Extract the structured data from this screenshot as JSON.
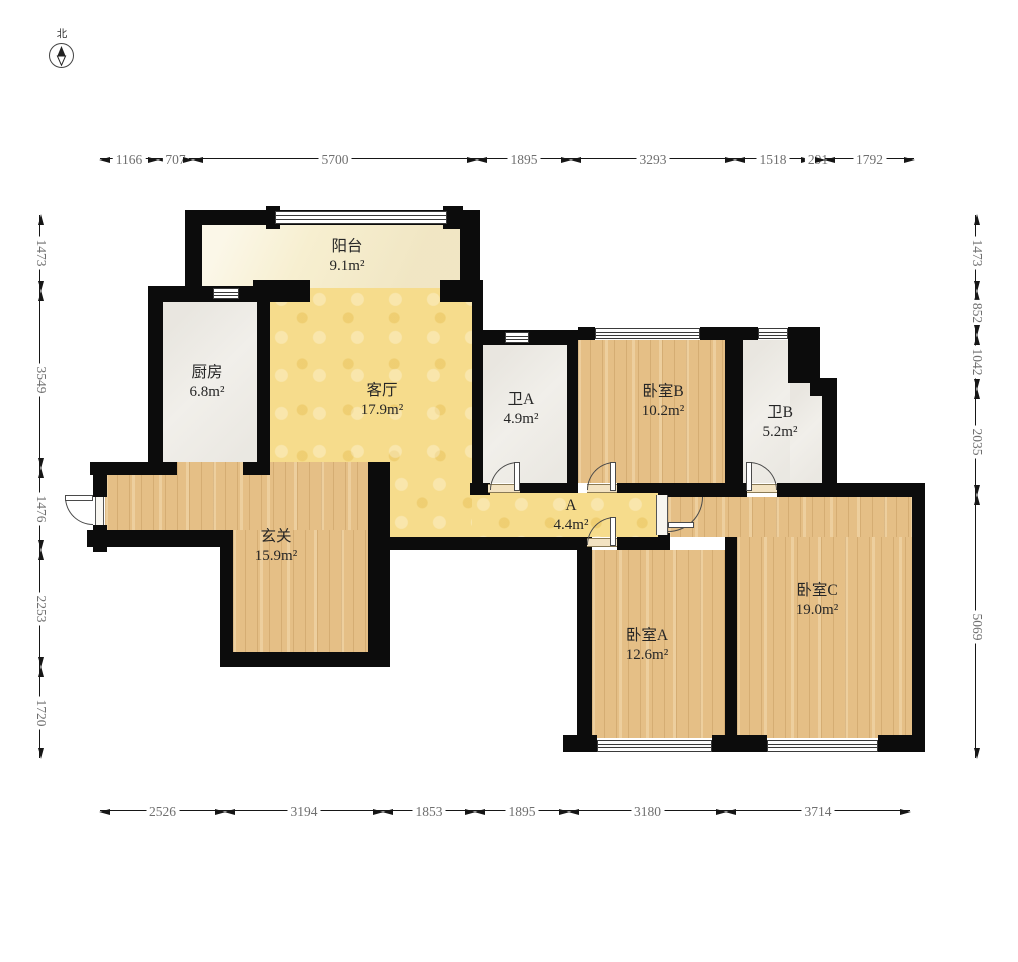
{
  "compass": {
    "label": "北"
  },
  "rooms": [
    {
      "id": "balcony",
      "name": "阳台",
      "area": "9.1m²"
    },
    {
      "id": "kitchen",
      "name": "厨房",
      "area": "6.8m²"
    },
    {
      "id": "living",
      "name": "客厅",
      "area": "17.9m²"
    },
    {
      "id": "bathA",
      "name": "卫A",
      "area": "4.9m²"
    },
    {
      "id": "bedB",
      "name": "卧室B",
      "area": "10.2m²"
    },
    {
      "id": "bathB",
      "name": "卫B",
      "area": "5.2m²"
    },
    {
      "id": "hallway",
      "name": "A",
      "area": "4.4m²"
    },
    {
      "id": "entry",
      "name": "玄关",
      "area": "15.9m²"
    },
    {
      "id": "bedA",
      "name": "卧室A",
      "area": "12.6m²"
    },
    {
      "id": "bedC",
      "name": "卧室C",
      "area": "19.0m²"
    }
  ],
  "dimensions": {
    "top": [
      "1166",
      "707",
      "5700",
      "1895",
      "3293",
      "1518",
      "291",
      "1792"
    ],
    "bottom": [
      "2526",
      "3194",
      "1853",
      "1895",
      "3180",
      "3714"
    ],
    "left": [
      "1473",
      "3549",
      "1476",
      "2253",
      "1720"
    ],
    "right": [
      "1473",
      "852",
      "1042",
      "2035",
      "5069"
    ]
  },
  "colors": {
    "wall": "#0c0c0c",
    "wood_floor": "#e5bf86",
    "living_floor": "#f6dc8c",
    "balcony_floor": "#f7efd0",
    "bath_floor": "#f1efea",
    "dim_text": "#6f6f6f"
  }
}
